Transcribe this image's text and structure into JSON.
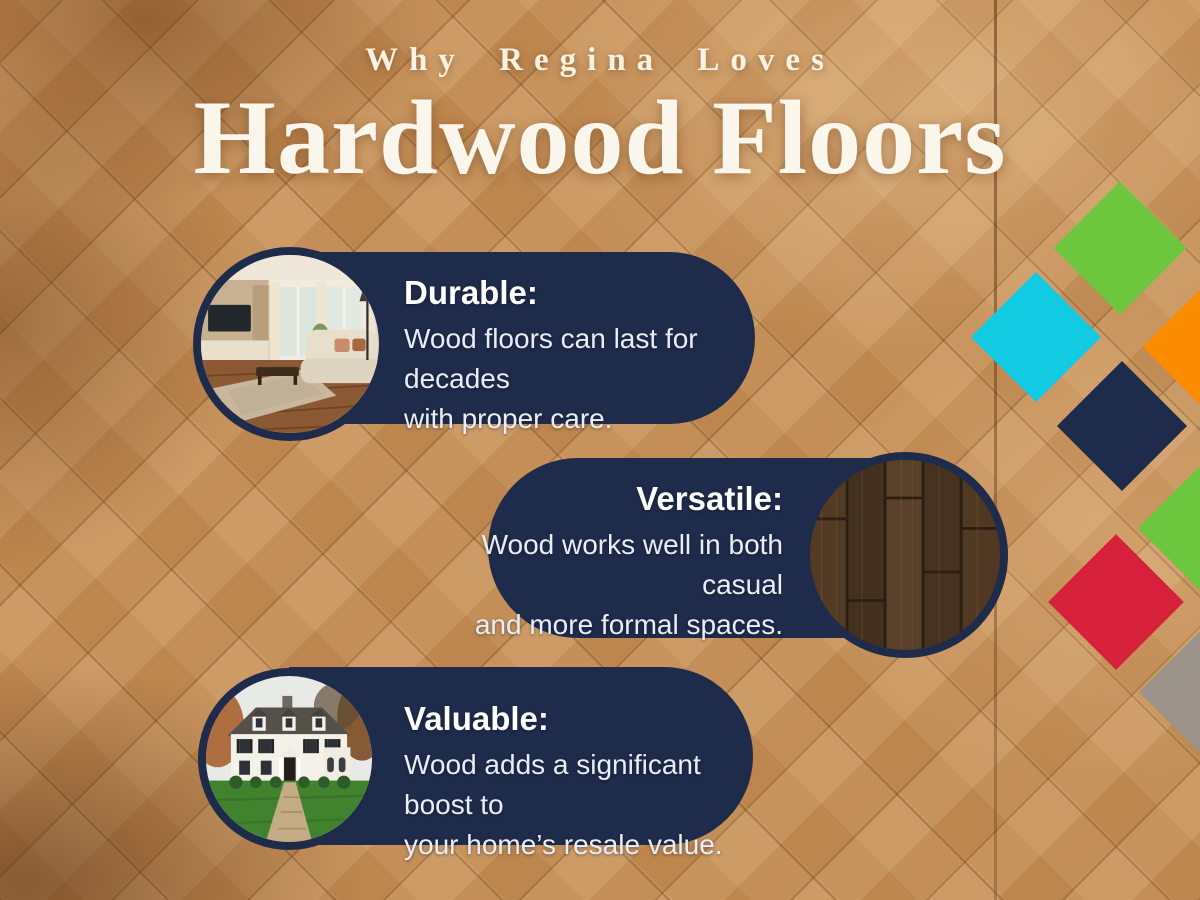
{
  "title": {
    "eyebrow": "Why Regina Loves",
    "main": "Hardwood Floors"
  },
  "cards": [
    {
      "id": "durable",
      "heading": "Durable:",
      "line1": "Wood floors can last for decades",
      "line2": "with proper care."
    },
    {
      "id": "versatile",
      "heading": "Versatile:",
      "line1": "Wood works well in both casual",
      "line2": "and more formal spaces."
    },
    {
      "id": "valuable",
      "heading": "Valuable:",
      "line1": "Wood adds a significant boost to",
      "line2": "your home’s resale value."
    }
  ],
  "colors": {
    "card_navy": "#1f2b4a",
    "title_cream": "#f8f2e3",
    "body_text": "#e9edf5"
  },
  "decor": {
    "diamonds": [
      {
        "name": "diamond-green-top",
        "color": "#6cc63e",
        "cx": 1120,
        "cy": 248,
        "size": 94
      },
      {
        "name": "diamond-cyan",
        "color": "#12cbe2",
        "cx": 1036,
        "cy": 337,
        "size": 92
      },
      {
        "name": "diamond-orange",
        "color": "#fb8c00",
        "cx": 1209,
        "cy": 347,
        "size": 94
      },
      {
        "name": "diamond-navy",
        "color": "#1f2b4a",
        "cx": 1122,
        "cy": 426,
        "size": 92
      },
      {
        "name": "diamond-green-right",
        "color": "#6cc63e",
        "cx": 1203,
        "cy": 528,
        "size": 92
      },
      {
        "name": "diamond-red",
        "color": "#d7213a",
        "cx": 1116,
        "cy": 602,
        "size": 96
      },
      {
        "name": "diamond-gray",
        "color": "#9b938a",
        "cx": 1207,
        "cy": 692,
        "size": 96
      }
    ]
  }
}
